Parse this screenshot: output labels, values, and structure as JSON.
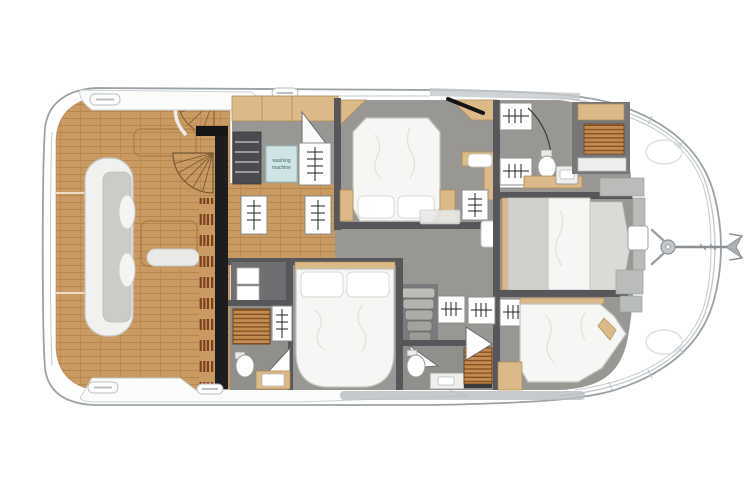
{
  "diagram": {
    "kind": "yacht-lower-deck-floor-plan",
    "orientation": "bow-right-stern-left"
  },
  "labels": {
    "washing_line1": "washing",
    "washing_line2": "machine"
  },
  "colors": {
    "teak": "#c99a62",
    "teak_line": "#b5854d",
    "floor": "#989793",
    "wall": "#57575b",
    "wall_black": "#1d1d1f",
    "wood": "#dcb988",
    "wood_dark": "#b08b55",
    "bed": "#f6f6f4",
    "bed_stroke": "#c2c2bf",
    "grate": "#c58a4f",
    "grate_line": "#7e4e22",
    "sofa": "#f1f1ef",
    "seat": "#cbcbc8",
    "hull_stroke": "#9aa2a6",
    "hull_inner": "#c2c8cb",
    "washing_bg": "#cfe4e4",
    "washing_text": "#486a6e",
    "metal": "#aab0b3"
  },
  "icons": {
    "anchor": "anchor-icon",
    "windlass": "windlass-icon",
    "cleat": "cleat-icon",
    "hanger_rack": "hanger-icon",
    "toilet": "toilet-icon",
    "sink": "sink-icon",
    "shower_grate": "shower-grate-icon",
    "stairs": "stairs-icon",
    "spiral_stairs": "spiral-stairs-icon",
    "door_swing": "door-swing-icon",
    "sofa": "sofa-icon",
    "bed": "bed-icon",
    "vent_grille": "vent-grille-icon",
    "washing_machine": "washing-machine-icon"
  }
}
